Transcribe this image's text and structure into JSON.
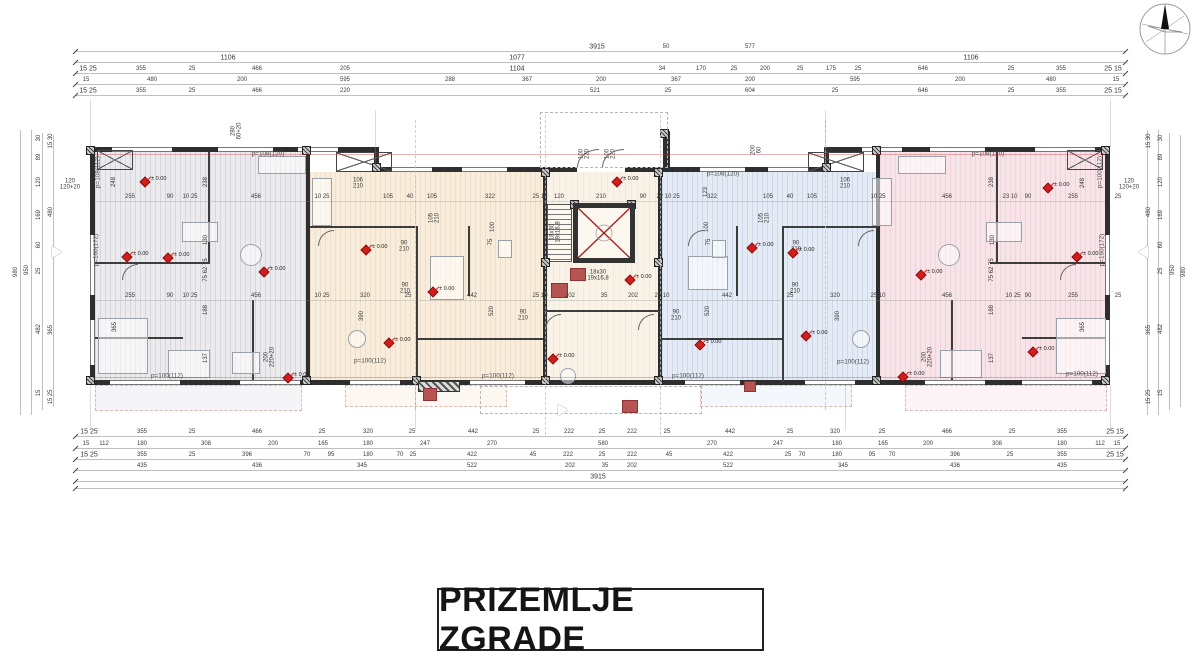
{
  "title_block": {
    "text": "PRIZEMLJE ZGRADE"
  },
  "marker_label": "± 0.00",
  "colors": {
    "marker_red": "#ce1f1f",
    "column_red": "#b65454",
    "wall": "#2e2e2e",
    "zone_left": "#ebebee",
    "zone_center_left": "#f8eddc",
    "zone_core": "#f9f2e6",
    "zone_center_right": "#e4ebf4",
    "zone_right": "#f7e4e9"
  },
  "dim_labels": {
    "top_rows": [
      {
        "y": 47,
        "items": [
          [
            "3915",
            597
          ],
          [
            "50",
            666
          ],
          [
            "577",
            750
          ]
        ]
      },
      {
        "y": 58,
        "items": [
          [
            "1106",
            228
          ],
          [
            "1077",
            517
          ],
          [
            "1106",
            971
          ]
        ]
      },
      {
        "y": 69,
        "items": [
          [
            "15 25",
            88
          ],
          [
            "355",
            141
          ],
          [
            "25",
            192
          ],
          [
            "466",
            257
          ],
          [
            "205",
            345
          ],
          [
            "1104",
            517
          ],
          [
            "34",
            662
          ],
          [
            "170",
            701
          ],
          [
            "25",
            734
          ],
          [
            "200",
            765
          ],
          [
            "25",
            800
          ],
          [
            "175",
            831
          ],
          [
            "25",
            858
          ],
          [
            "646",
            923
          ],
          [
            "25",
            1011
          ],
          [
            "355",
            1061
          ],
          [
            "25 15",
            1113
          ]
        ]
      },
      {
        "y": 80,
        "items": [
          [
            "15",
            86
          ],
          [
            "480",
            152
          ],
          [
            "200",
            242
          ],
          [
            "595",
            345
          ],
          [
            "288",
            450
          ],
          [
            "367",
            527
          ],
          [
            "200",
            601
          ],
          [
            "367",
            676
          ],
          [
            "200",
            750
          ],
          [
            "595",
            855
          ],
          [
            "200",
            960
          ],
          [
            "480",
            1051
          ],
          [
            "15",
            1116
          ]
        ]
      },
      {
        "y": 91,
        "items": [
          [
            "15 25",
            88
          ],
          [
            "355",
            141
          ],
          [
            "25",
            192
          ],
          [
            "466",
            257
          ],
          [
            "220",
            345
          ],
          [
            "521",
            595
          ],
          [
            "25",
            668
          ],
          [
            "604",
            750
          ],
          [
            "25",
            835
          ],
          [
            "646",
            923
          ],
          [
            "25",
            1011
          ],
          [
            "355",
            1061
          ],
          [
            "25 15",
            1113
          ]
        ]
      }
    ],
    "bottom_rows": [
      {
        "y": 432,
        "items": [
          [
            "15 25",
            89
          ],
          [
            "355",
            142
          ],
          [
            "25",
            192
          ],
          [
            "466",
            257
          ],
          [
            "25",
            322
          ],
          [
            "320",
            368
          ],
          [
            "25",
            412
          ],
          [
            "442",
            473
          ],
          [
            "25",
            536
          ],
          [
            "222",
            569
          ],
          [
            "25",
            602
          ],
          [
            "222",
            632
          ],
          [
            "25",
            667
          ],
          [
            "442",
            730
          ],
          [
            "25",
            790
          ],
          [
            "320",
            835
          ],
          [
            "25",
            882
          ],
          [
            "466",
            947
          ],
          [
            "25",
            1012
          ],
          [
            "355",
            1062
          ],
          [
            "25 15",
            1115
          ]
        ]
      },
      {
        "y": 444,
        "items": [
          [
            "15",
            86
          ],
          [
            "112",
            104
          ],
          [
            "180",
            142
          ],
          [
            "308",
            206
          ],
          [
            "200",
            273
          ],
          [
            "165",
            323
          ],
          [
            "180",
            368
          ],
          [
            "247",
            425
          ],
          [
            "270",
            492
          ],
          [
            "580",
            603
          ],
          [
            "270",
            712
          ],
          [
            "247",
            778
          ],
          [
            "180",
            837
          ],
          [
            "165",
            883
          ],
          [
            "200",
            928
          ],
          [
            "308",
            997
          ],
          [
            "180",
            1062
          ],
          [
            "112",
            1100
          ],
          [
            "15",
            1117
          ]
        ]
      },
      {
        "y": 455,
        "items": [
          [
            "15 25",
            89
          ],
          [
            "355",
            142
          ],
          [
            "25",
            192
          ],
          [
            "396",
            247
          ],
          [
            "70",
            307
          ],
          [
            "95",
            331
          ],
          [
            "180",
            368
          ],
          [
            "70",
            400
          ],
          [
            "25",
            413
          ],
          [
            "422",
            472
          ],
          [
            "45",
            533
          ],
          [
            "222",
            568
          ],
          [
            "25",
            602
          ],
          [
            "222",
            632
          ],
          [
            "45",
            669
          ],
          [
            "422",
            728
          ],
          [
            "25",
            788
          ],
          [
            "70",
            802
          ],
          [
            "180",
            837
          ],
          [
            "95",
            872
          ],
          [
            "70",
            892
          ],
          [
            "396",
            955
          ],
          [
            "25",
            1010
          ],
          [
            "355",
            1062
          ],
          [
            "25 15",
            1115
          ]
        ]
      },
      {
        "y": 466,
        "items": [
          [
            "435",
            142
          ],
          [
            "436",
            257
          ],
          [
            "345",
            362
          ],
          [
            "522",
            472
          ],
          [
            "202",
            570
          ],
          [
            "35",
            605
          ],
          [
            "202",
            632
          ],
          [
            "522",
            728
          ],
          [
            "345",
            843
          ],
          [
            "436",
            955
          ],
          [
            "435",
            1062
          ]
        ]
      },
      {
        "y": 477,
        "items": [
          [
            "3915",
            598
          ]
        ]
      }
    ],
    "interior_rows": [
      {
        "y": 197,
        "items": [
          [
            "255",
            130
          ],
          [
            "90",
            170
          ],
          [
            "10 25",
            190
          ],
          [
            "456",
            256
          ],
          [
            "10 25",
            322
          ],
          [
            "105",
            388
          ],
          [
            "40",
            410
          ],
          [
            "105",
            432
          ],
          [
            "322",
            490
          ],
          [
            "25 10",
            540
          ],
          [
            "120",
            559
          ],
          [
            "210",
            601
          ],
          [
            "90",
            643
          ],
          [
            "22 10 25",
            668
          ],
          [
            "322",
            712
          ],
          [
            "105",
            768
          ],
          [
            "40",
            790
          ],
          [
            "105",
            812
          ],
          [
            "10 25",
            878
          ],
          [
            "456",
            947
          ],
          [
            "23 10",
            1010
          ],
          [
            "90",
            1028
          ],
          [
            "255",
            1073
          ],
          [
            "25",
            1118
          ]
        ]
      },
      {
        "y": 296,
        "items": [
          [
            "255",
            130
          ],
          [
            "90",
            170
          ],
          [
            "10 25",
            190
          ],
          [
            "456",
            256
          ],
          [
            "10 25",
            322
          ],
          [
            "320",
            365
          ],
          [
            "25",
            408
          ],
          [
            "442",
            472
          ],
          [
            "25 10",
            540
          ],
          [
            "202",
            570
          ],
          [
            "35",
            604
          ],
          [
            "202",
            633
          ],
          [
            "25 10",
            662
          ],
          [
            "442",
            727
          ],
          [
            "25",
            790
          ],
          [
            "320",
            835
          ],
          [
            "25 10",
            878
          ],
          [
            "456",
            947
          ],
          [
            "10 25",
            1013
          ],
          [
            "90",
            1028
          ],
          [
            "255",
            1073
          ],
          [
            "25",
            1118
          ]
        ]
      }
    ],
    "left_col": [
      [
        "980",
        16,
        272,
        1
      ],
      [
        "950",
        27,
        270,
        1
      ],
      [
        "30",
        39,
        138,
        1
      ],
      [
        "89",
        39,
        157,
        1
      ],
      [
        "120",
        39,
        182,
        1
      ],
      [
        "169",
        39,
        215,
        1
      ],
      [
        "60",
        39,
        245,
        1
      ],
      [
        "25",
        39,
        271,
        1
      ],
      [
        "482",
        39,
        329,
        1
      ],
      [
        "15",
        39,
        393,
        1
      ],
      [
        "15 30",
        51,
        141,
        1
      ],
      [
        "480",
        51,
        212,
        1
      ],
      [
        "365",
        51,
        330,
        1
      ],
      [
        "15 25",
        51,
        397,
        1
      ]
    ],
    "right_col": [
      [
        "980",
        1184,
        272,
        1
      ],
      [
        "950",
        1173,
        270,
        1
      ],
      [
        "30",
        1161,
        138,
        1
      ],
      [
        "89",
        1161,
        157,
        1
      ],
      [
        "120",
        1161,
        182,
        1
      ],
      [
        "169",
        1161,
        215,
        1
      ],
      [
        "60",
        1161,
        245,
        1
      ],
      [
        "25",
        1161,
        271,
        1
      ],
      [
        "482",
        1161,
        329,
        1
      ],
      [
        "15",
        1161,
        393,
        1
      ],
      [
        "15 30",
        1149,
        141,
        1
      ],
      [
        "480",
        1149,
        212,
        1
      ],
      [
        "365",
        1149,
        330,
        1
      ],
      [
        "15 25",
        1149,
        397,
        1
      ]
    ],
    "plan_labels": [
      [
        "p=108(112)",
        99,
        172,
        1
      ],
      [
        "p=160(172)",
        97,
        250,
        1
      ],
      [
        "p=100(112)",
        167,
        377,
        0
      ],
      [
        "p=108(120)",
        268,
        155,
        0
      ],
      [
        "p=100(112)",
        370,
        362,
        0
      ],
      [
        "p=100(112)",
        498,
        377,
        0
      ],
      [
        "p=108(120)",
        723,
        175,
        0
      ],
      [
        "p=100(112)",
        688,
        377,
        0
      ],
      [
        "p=100(112)",
        853,
        363,
        0
      ],
      [
        "p=108(120)",
        988,
        155,
        0
      ],
      [
        "p=100(112)",
        1101,
        172,
        1
      ],
      [
        "p=160(172)",
        1103,
        250,
        1
      ],
      [
        "p=100(112)",
        1082,
        375,
        0
      ],
      [
        "248",
        114,
        182,
        1
      ],
      [
        "238",
        206,
        182,
        1
      ],
      [
        "130",
        206,
        240,
        1
      ],
      [
        "75 62 75",
        206,
        270,
        1
      ],
      [
        "188",
        206,
        310,
        1
      ],
      [
        "365",
        115,
        327,
        1
      ],
      [
        "137",
        206,
        358,
        1
      ],
      [
        "200\n220+20",
        270,
        357,
        1
      ],
      [
        "238",
        992,
        182,
        1
      ],
      [
        "248",
        1083,
        183,
        1
      ],
      [
        "130",
        993,
        240,
        1
      ],
      [
        "75 62 75",
        992,
        270,
        1
      ],
      [
        "188",
        992,
        310,
        1
      ],
      [
        "365",
        1083,
        327,
        1
      ],
      [
        "137",
        992,
        358,
        1
      ],
      [
        "200\n220+20",
        928,
        357,
        1
      ],
      [
        "520",
        492,
        311,
        1
      ],
      [
        "390",
        362,
        316,
        1
      ],
      [
        "520",
        708,
        311,
        1
      ],
      [
        "390",
        838,
        316,
        1
      ],
      [
        "100",
        493,
        227,
        1
      ],
      [
        "75",
        491,
        242,
        1
      ],
      [
        "100",
        707,
        227,
        1
      ],
      [
        "75",
        709,
        242,
        1
      ],
      [
        "123",
        706,
        192,
        1
      ],
      [
        "280\n60+20",
        237,
        131,
        1
      ],
      [
        "200\n60",
        757,
        150,
        1
      ],
      [
        "18x30\n19x16,8",
        556,
        232,
        1
      ],
      [
        "150\n260",
        600,
        221,
        1
      ],
      [
        "18x30\n19x16,8",
        598,
        276,
        0
      ],
      [
        "106\n210",
        358,
        184,
        0
      ],
      [
        "106\n210",
        845,
        184,
        0
      ],
      [
        "90\n210",
        404,
        247,
        0
      ],
      [
        "90\n210",
        796,
        247,
        0
      ],
      [
        "90\n210",
        405,
        289,
        0
      ],
      [
        "90\n210",
        795,
        289,
        0
      ],
      [
        "90\n210",
        523,
        316,
        0
      ],
      [
        "90\n210",
        676,
        316,
        0
      ],
      [
        "105\n210",
        435,
        218,
        1
      ],
      [
        "105\n210",
        765,
        218,
        1
      ],
      [
        "100\n220",
        585,
        154,
        1
      ],
      [
        "100\n220",
        611,
        154,
        1
      ],
      [
        "120\n120+20",
        70,
        185,
        0
      ],
      [
        "120\n120+20",
        1129,
        185,
        0
      ]
    ]
  },
  "markers": [
    [
      145,
      182
    ],
    [
      617,
      182
    ],
    [
      1048,
      188
    ],
    [
      127,
      257
    ],
    [
      168,
      258
    ],
    [
      366,
      250
    ],
    [
      752,
      248
    ],
    [
      793,
      253
    ],
    [
      921,
      275
    ],
    [
      1077,
      257
    ],
    [
      264,
      272
    ],
    [
      433,
      292
    ],
    [
      630,
      280
    ],
    [
      389,
      343
    ],
    [
      553,
      359
    ],
    [
      700,
      345
    ],
    [
      806,
      336
    ],
    [
      1033,
      352
    ],
    [
      288,
      378
    ],
    [
      903,
      377
    ]
  ]
}
